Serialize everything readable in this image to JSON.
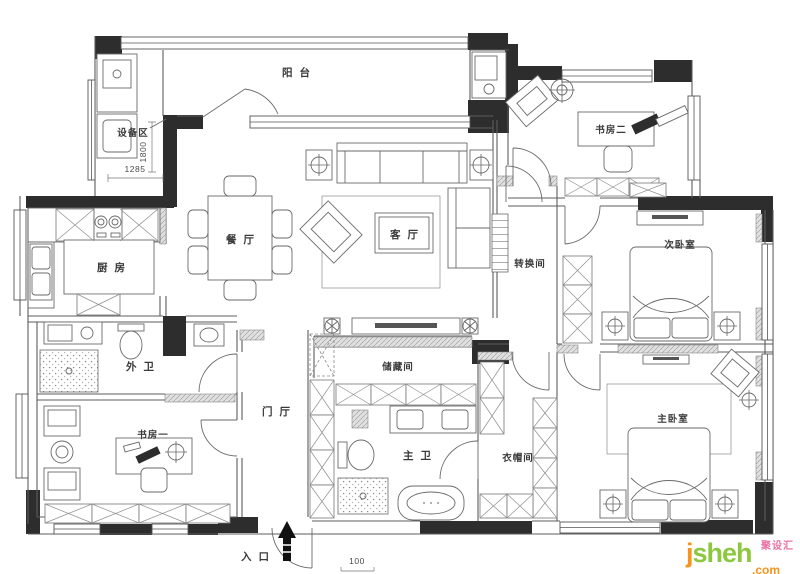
{
  "rooms": {
    "balcony": {
      "label": "阳 台"
    },
    "equipment_area": {
      "label": "设备区"
    },
    "kitchen": {
      "label": "厨 房"
    },
    "dining": {
      "label": "餐 厅"
    },
    "living": {
      "label": "客 厅"
    },
    "study_two": {
      "label": "书房二"
    },
    "transition": {
      "label": "转换间"
    },
    "bedroom_two": {
      "label": "次卧室"
    },
    "guest_bath": {
      "label": "外 卫"
    },
    "study_one": {
      "label": "书房一"
    },
    "foyer": {
      "label": "门 厅"
    },
    "storage": {
      "label": "储藏间"
    },
    "master_bath": {
      "label": "主 卫"
    },
    "cloakroom": {
      "label": "衣帽间"
    },
    "master_bedroom": {
      "label": "主卧室"
    }
  },
  "annotations": {
    "entrance": "入 口",
    "dim_width": "1285",
    "dim_depth": "1800",
    "scale_marker": "100"
  },
  "watermark": {
    "brand_first": "j",
    "brand_rest": "sheh",
    "brand_tld": ".com",
    "brand_cn": "聚设汇",
    "color_orange": "#F7941E",
    "color_green": "#8DC63F",
    "color_pink": "#EC6FA5"
  }
}
